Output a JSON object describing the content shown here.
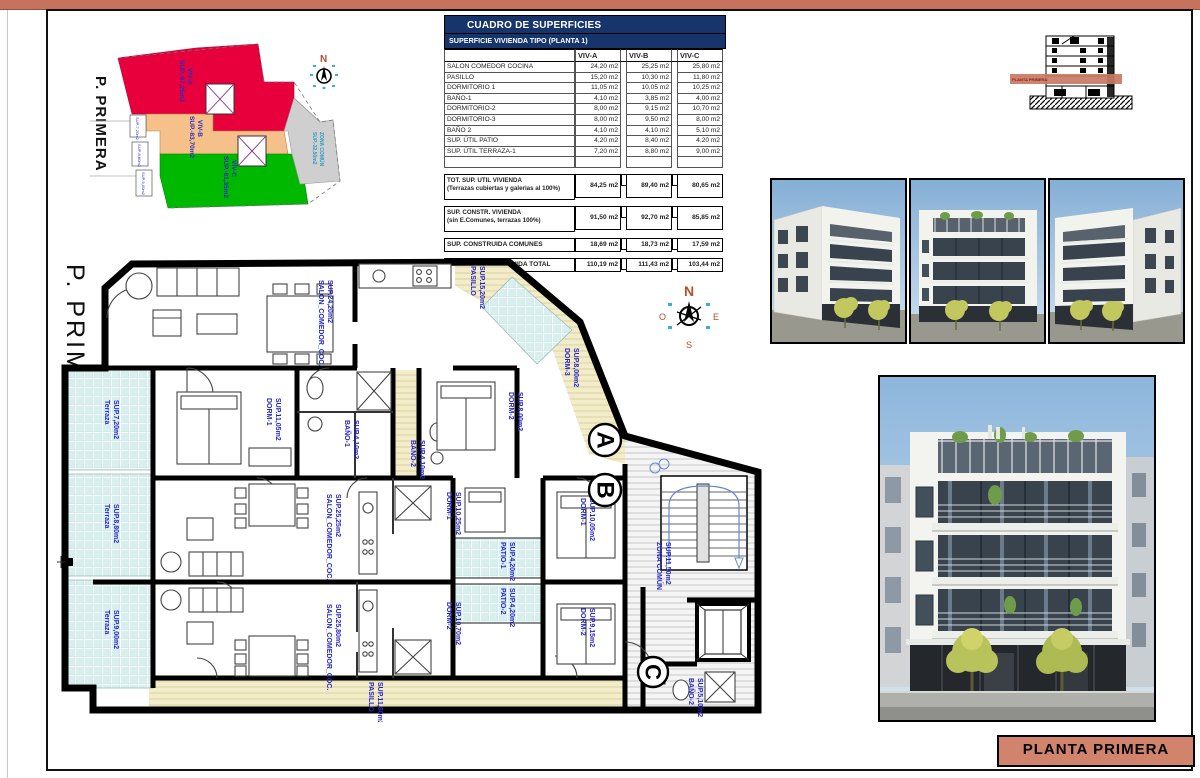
{
  "sheet": {
    "accent_color": "#c7725c",
    "title_block": {
      "label": "PLANTA PRIMERA"
    }
  },
  "key_plan": {
    "floor_label": "P. PRIMERA",
    "north_letter": "N",
    "zones": [
      {
        "name": "VIV-A",
        "sup": "SUP.-87,25m2",
        "color": "#e8003c"
      },
      {
        "name": "VIV-B",
        "sup": "SUP.-83,70m2",
        "color": "#f5c089"
      },
      {
        "name": "VIV-C",
        "sup": "SUP.-81,35m2",
        "color": "#00b800"
      },
      {
        "name": "ZONA COMÚN",
        "sup": "SUP.-32,50m2",
        "color": "#cfcfcf"
      }
    ]
  },
  "section_thumb": {
    "band_label": "PLANTA PRIMERA"
  },
  "surface_table": {
    "title": "CUADRO DE SUPERFICIES",
    "subtitle": "SUPERFICIE VIVIENDA TIPO  (PLANTA 1)",
    "columns": [
      "VIV-A",
      "VIV-B",
      "VIV-C"
    ],
    "rows": [
      {
        "label": "SALON COMEDOR COCINA",
        "a": "24,20 m2",
        "b": "25,25 m2",
        "c": "25,80 m2"
      },
      {
        "label": "PASILLO",
        "a": "15,20 m2",
        "b": "10,30 m2",
        "c": "11,80 m2"
      },
      {
        "label": "DORMITORIO 1",
        "a": "11,05 m2",
        "b": "10,05 m2",
        "c": "10,25 m2"
      },
      {
        "label": "BAÑO-1",
        "a": "4,10 m2",
        "b": "3,85 m2",
        "c": "4,00 m2"
      },
      {
        "label": "DORMITORIO-2",
        "a": "8,00 m2",
        "b": "9,15 m2",
        "c": "10,70 m2"
      },
      {
        "label": "DORMITORIO-3",
        "a": "8,00 m2",
        "b": "9,50 m2",
        "c": "8,00 m2"
      },
      {
        "label": "BAÑO 2",
        "a": "4,10 m2",
        "b": "4,10 m2",
        "c": "5,10 m2"
      },
      {
        "label": "SUP. ÚTIL PATIO",
        "a": "4,20 m2",
        "b": "8,40 m2",
        "c": "4,20 m2"
      },
      {
        "label": "SUP. ÚTIL TERRAZA-1",
        "a": "7,20 m2",
        "b": "8,80 m2",
        "c": "9,00 m2"
      }
    ],
    "summary_rows": [
      {
        "label": "TOT. SUP. UTIL VIVIENDA",
        "label2": "(Terrazas cubiertas y galerias al 100%)",
        "a": "84,25 m2",
        "b": "89,40 m2",
        "c": "80,65 m2"
      },
      {
        "label": "SUP. CONSTR. VIVIENDA",
        "label2": "(sin E.Comunes, terrazas 100%)",
        "a": "91,50 m2",
        "b": "92,70 m2",
        "c": "85,85 m2"
      },
      {
        "label": "SUP. CONSTRUIDA COMUNES",
        "label2": "",
        "a": "18,69 m2",
        "b": "18,73 m2",
        "c": "17,59 m2"
      },
      {
        "label": "SUPERFIIE CONSTRUIDA TOTAL",
        "label2": "",
        "a": "110,19 m2",
        "b": "111,43 m2",
        "c": "103,44 m2"
      }
    ]
  },
  "plan": {
    "floor_label": "P. PRIMERA",
    "compass": {
      "n": "N",
      "e": "E",
      "s": "S",
      "o": "O"
    },
    "blocks": {
      "a": "A",
      "b": "B",
      "c": "C"
    },
    "labels": [
      {
        "name": "SALON_COMEDOR_COC.",
        "sup": "SUP.24,20m2"
      },
      {
        "name": "PASILLO",
        "sup": "SUP.15,20m2"
      },
      {
        "name": "DORM-1",
        "sup": "SUP.11,05m2"
      },
      {
        "name": "BAÑO-1",
        "sup": "SUP.4,10m2"
      },
      {
        "name": "DORM-2",
        "sup": "SUP.8,00m2"
      },
      {
        "name": "DORM-3",
        "sup": "SUP.8,00m2"
      },
      {
        "name": "Terraza",
        "sup": "SUP.7,20m2"
      },
      {
        "name": "Terraza",
        "sup": "SUP.8,80m2"
      },
      {
        "name": "Terraza",
        "sup": "SUP.9,00m2"
      },
      {
        "name": "SALON_COMEDOR_COC.",
        "sup": "SUP.25,25m2"
      },
      {
        "name": "SALON_COMEDOR_COC.",
        "sup": "SUP.25,80m2"
      },
      {
        "name": "PATIO-1",
        "sup": "SUP.4,20m2"
      },
      {
        "name": "PATIO-2",
        "sup": "SUP.4,20m2"
      },
      {
        "name": "DORM-1",
        "sup": "SUP.10,05m2"
      },
      {
        "name": "DORM-2",
        "sup": "SUP.9,15m2"
      },
      {
        "name": "DORM-1",
        "sup": "SUP.10,25m2"
      },
      {
        "name": "DORM-2",
        "sup": "SUP.10,70m2"
      },
      {
        "name": "BAÑO-2",
        "sup": "SUP.4,10m2"
      },
      {
        "name": "ZONA COMÚN",
        "sup": "SUP.11,50m2"
      },
      {
        "name": "PASILLO",
        "sup": "SUP.11,80m2"
      },
      {
        "name": "BAÑO-2",
        "sup": "SUP.5,10m2"
      }
    ]
  }
}
